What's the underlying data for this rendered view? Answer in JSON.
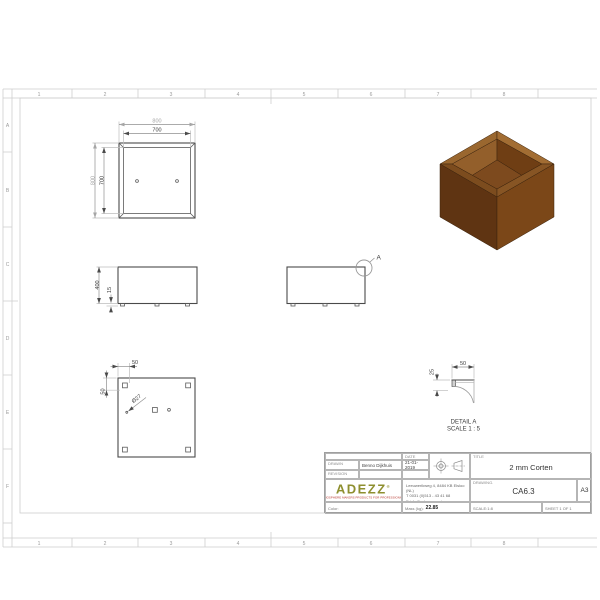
{
  "frame": {
    "columns": [
      "1",
      "2",
      "3",
      "4",
      "5",
      "6",
      "7",
      "8"
    ],
    "rows": [
      "A",
      "B",
      "C",
      "D",
      "E",
      "F"
    ]
  },
  "views": {
    "top": {
      "dim_outer_width": "800",
      "dim_inner_width": "700",
      "dim_outer_height": "800",
      "dim_inner_height": "700"
    },
    "front": {
      "dim_height": "400",
      "dim_base": "15"
    },
    "side": {
      "detail_marker": "A"
    },
    "bottom": {
      "dim_offset_top": "50",
      "dim_offset_left": "50",
      "dim_hole": "Ø27"
    },
    "detail": {
      "dim_width": "50",
      "dim_height": "25",
      "label": "DETAIL A",
      "scale": "SCALE 1 : 5"
    }
  },
  "title_block": {
    "drawn_label": "DRAWN",
    "drawn_value": "Benno Dijkhuis",
    "revision_label": "REVISION",
    "date_label": "DATE",
    "date_value": "21-01-2019",
    "title_label": "TITLE",
    "title_value": "2 mm Corten",
    "logo_text": "ADEZZ",
    "logo_reg": "®",
    "logo_tagline": "ATMOSPHERE MAKERS PRODUCTS FOR PROFESSIONALS",
    "address_line1": "Leeuwerikweg 4, 8484 KB Elsloo (NL)",
    "address_line2": "T 0031 (0)513 - 43 41 68",
    "address_line3": "E info@adezz.com / www.adezz.com",
    "drawing_label": "Drawing.",
    "drawing_number": "CA6.3",
    "paper_size": "A3",
    "color_label": "Color:",
    "mass_label": "Mass (kg):",
    "mass_value": "22.85",
    "scale_text": "SCALE:1:8",
    "sheet_text": "SHEET 1 OF 1"
  },
  "colors": {
    "brand_logo": "#8e8f2f",
    "brand_tagline": "#b5342c",
    "corten": {
      "outline": "#3a220c",
      "face_left": "#5f3412",
      "face_right": "#7b4718",
      "rim_top_left": "#9a672f",
      "rim_top_right": "#a26d33",
      "rim_front_left": "#7c4c1e",
      "rim_front_right": "#875524",
      "wall_back_left": "#935f2b",
      "wall_back_right": "#6f3e14",
      "wall_front_left": "#4f2a0c",
      "wall_front_right": "#5c310d",
      "floor": "#7d4a1e"
    }
  }
}
